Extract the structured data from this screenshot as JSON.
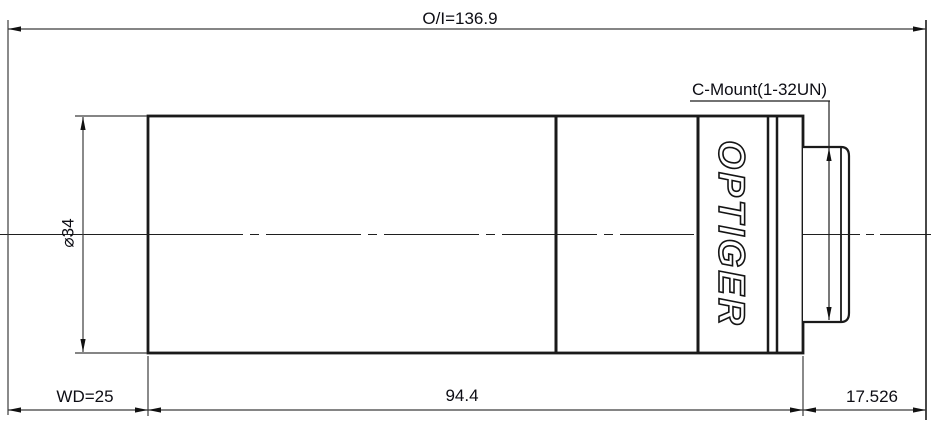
{
  "drawing": {
    "labels": {
      "overall_length": "O/I=136.9",
      "mount_thread": "C-Mount(1-32UN)",
      "diameter": "⌀34",
      "working_distance": "WD=25",
      "barrel_length": "94.4",
      "flange_back": "17.526",
      "brand": "OPTIGER"
    },
    "colors": {
      "background": "#ffffff",
      "outline": "#1a1a1a",
      "dimension_line": "#3c3c3c",
      "text": "#0d0d14"
    }
  }
}
